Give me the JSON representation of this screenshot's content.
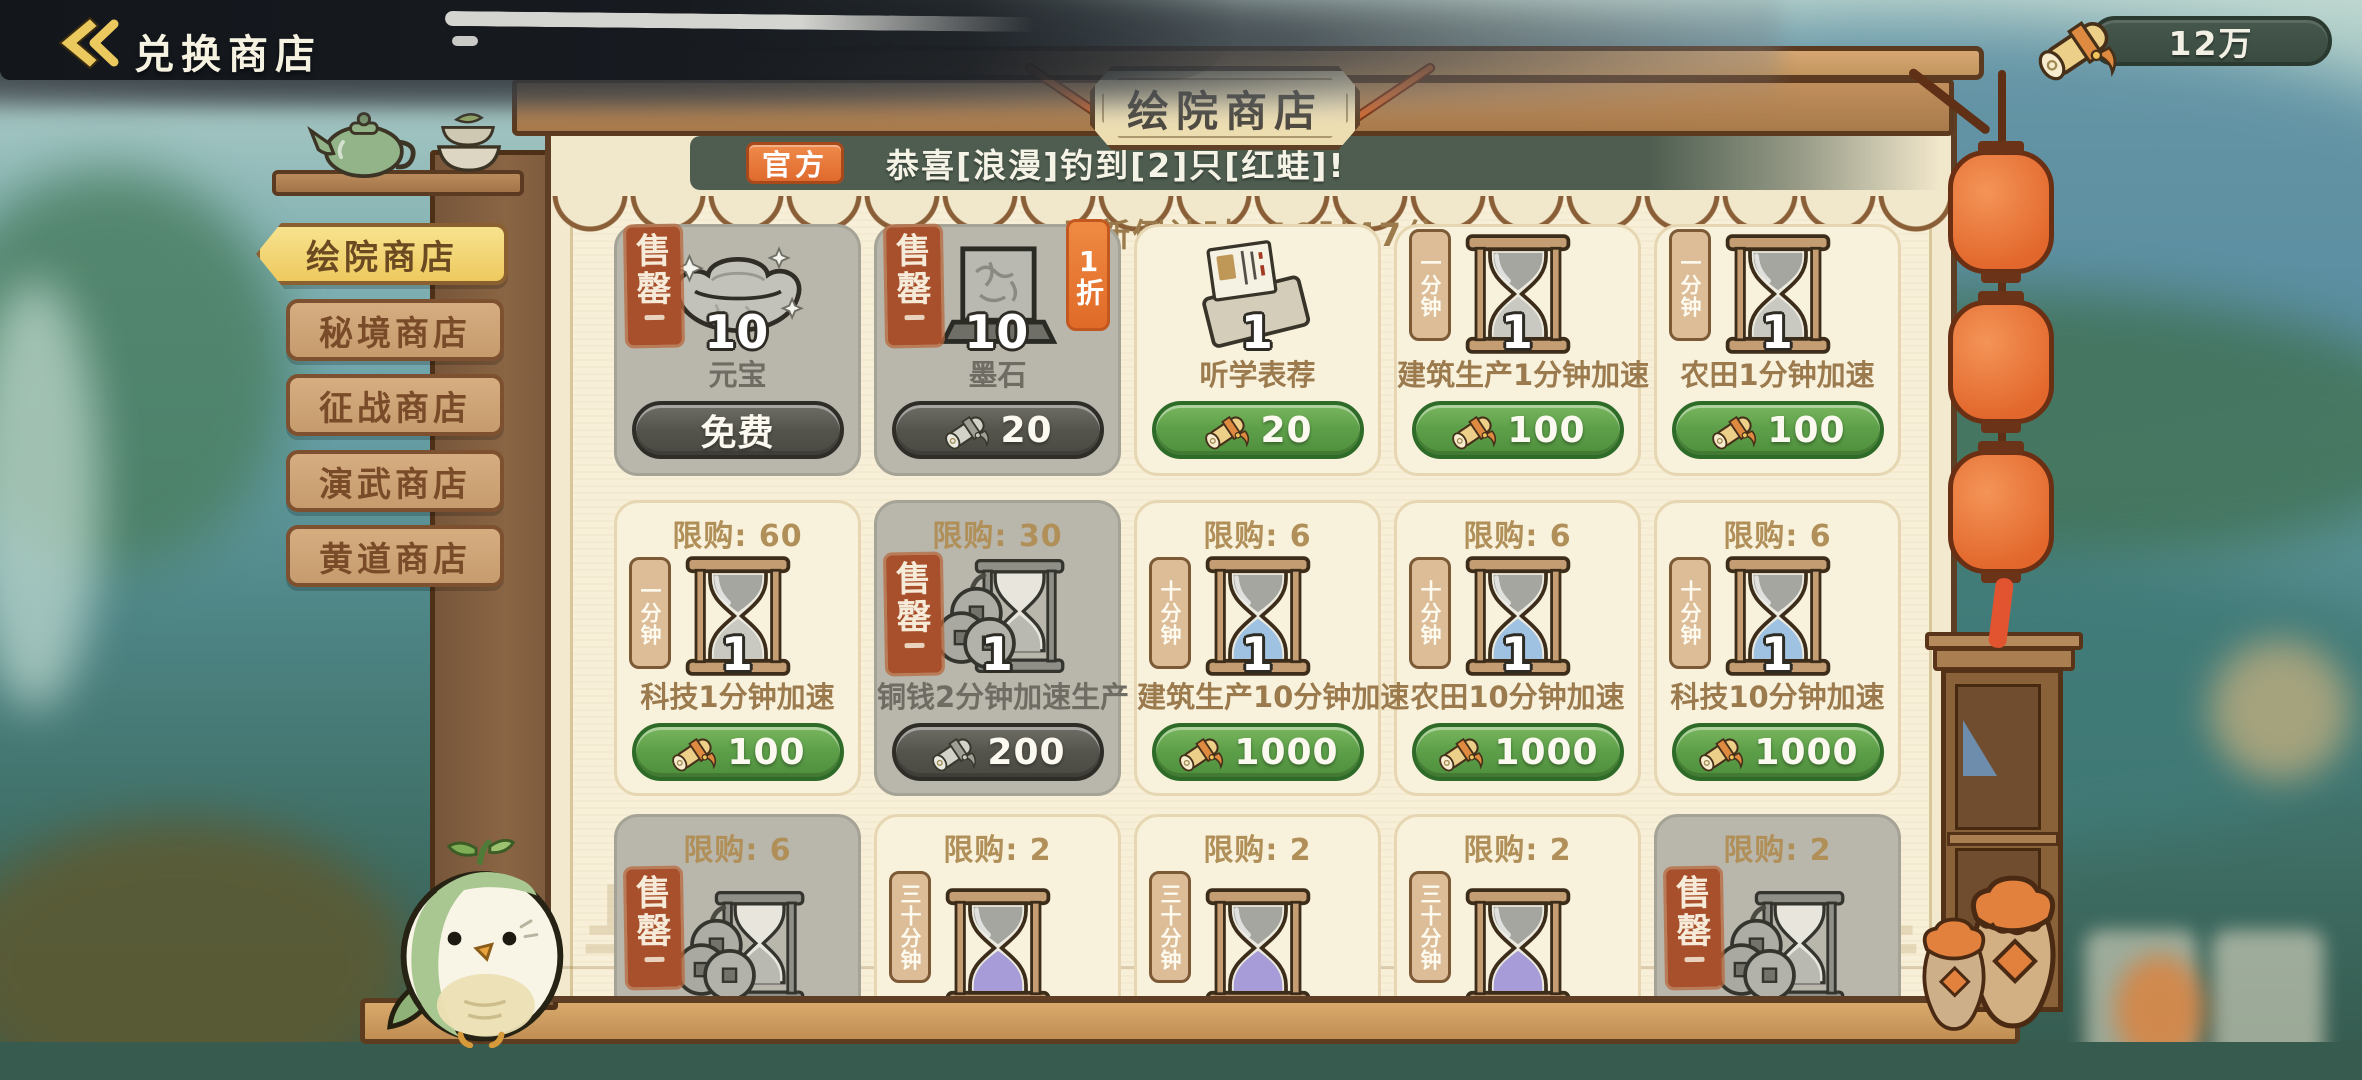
{
  "header": {
    "title": "兑换商店"
  },
  "currency": {
    "amount": "12万",
    "icon": "scroll-currency"
  },
  "shop": {
    "plaque_title": "绘院商店",
    "announcement": {
      "badge": "官方",
      "text": "恭喜[浪漫]钓到[2]只[红蛙]!"
    },
    "refresh_countdown": "刷新倒计时: 19时47分",
    "sold_out_label": "售罄",
    "tabs": [
      {
        "label": "绘院商店",
        "selected": true
      },
      {
        "label": "秘境商店",
        "selected": false
      },
      {
        "label": "征战商店",
        "selected": false
      },
      {
        "label": "演武商店",
        "selected": false
      },
      {
        "label": "黄道商店",
        "selected": false
      }
    ],
    "items": [
      {
        "name": "元宝",
        "quantity": "10",
        "price": "免费",
        "price_state": "disabled",
        "sold_out": true,
        "icon": "ingot"
      },
      {
        "name": "墨石",
        "quantity": "10",
        "price": "20",
        "price_state": "disabled",
        "sold_out": true,
        "icon": "inkstone",
        "discount": "1折"
      },
      {
        "name": "听学表荐",
        "quantity": "1",
        "price": "20",
        "price_state": "enabled",
        "icon": "letter"
      },
      {
        "name": "建筑生产1分钟加速",
        "quantity": "1",
        "price": "100",
        "price_state": "enabled",
        "icon": "hourglass",
        "time_tag": "一分钟",
        "sand": "gray"
      },
      {
        "name": "农田1分钟加速",
        "quantity": "1",
        "price": "100",
        "price_state": "enabled",
        "icon": "hourglass",
        "time_tag": "一分钟",
        "sand": "gray"
      },
      {
        "limit": "限购: 60",
        "name": "科技1分钟加速",
        "quantity": "1",
        "price": "100",
        "price_state": "enabled",
        "icon": "hourglass",
        "time_tag": "一分钟",
        "sand": "gray"
      },
      {
        "limit": "限购: 30",
        "name": "铜钱2分钟加速生产",
        "quantity": "1",
        "price": "200",
        "price_state": "disabled",
        "sold_out": true,
        "icon": "coins"
      },
      {
        "limit": "限购: 6",
        "name": "建筑生产10分钟加速",
        "quantity": "1",
        "price": "1000",
        "price_state": "enabled",
        "icon": "hourglass",
        "time_tag": "十分钟",
        "sand": "blue"
      },
      {
        "limit": "限购: 6",
        "name": "农田10分钟加速",
        "quantity": "1",
        "price": "1000",
        "price_state": "enabled",
        "icon": "hourglass",
        "time_tag": "十分钟",
        "sand": "blue"
      },
      {
        "limit": "限购: 6",
        "name": "科技10分钟加速",
        "quantity": "1",
        "price": "1000",
        "price_state": "enabled",
        "icon": "hourglass",
        "time_tag": "十分钟",
        "sand": "blue"
      },
      {
        "limit": "限购: 6",
        "sold_out": true,
        "icon": "coins"
      },
      {
        "limit": "限购: 2",
        "icon": "hourglass",
        "time_tag": "三十分钟",
        "sand": "purple"
      },
      {
        "limit": "限购: 2",
        "icon": "hourglass",
        "time_tag": "三十分钟",
        "sand": "purple"
      },
      {
        "limit": "限购: 2",
        "icon": "hourglass",
        "time_tag": "三十分钟",
        "sand": "purple"
      },
      {
        "limit": "限购: 2",
        "sold_out": true,
        "icon": "coins"
      }
    ]
  },
  "colors": {
    "buy_green": "#5f9e45",
    "disabled_gray": "#56554e",
    "announcement_bg": "#4e5d50",
    "badge_orange": "#e3743b",
    "tab_selected_gold": "#f2d470",
    "lantern_orange": "#e8743c",
    "sold_stamp_red": "#a8502c",
    "plaque_cream": "#f0e2ba",
    "wood_brown": "#8a6544"
  }
}
